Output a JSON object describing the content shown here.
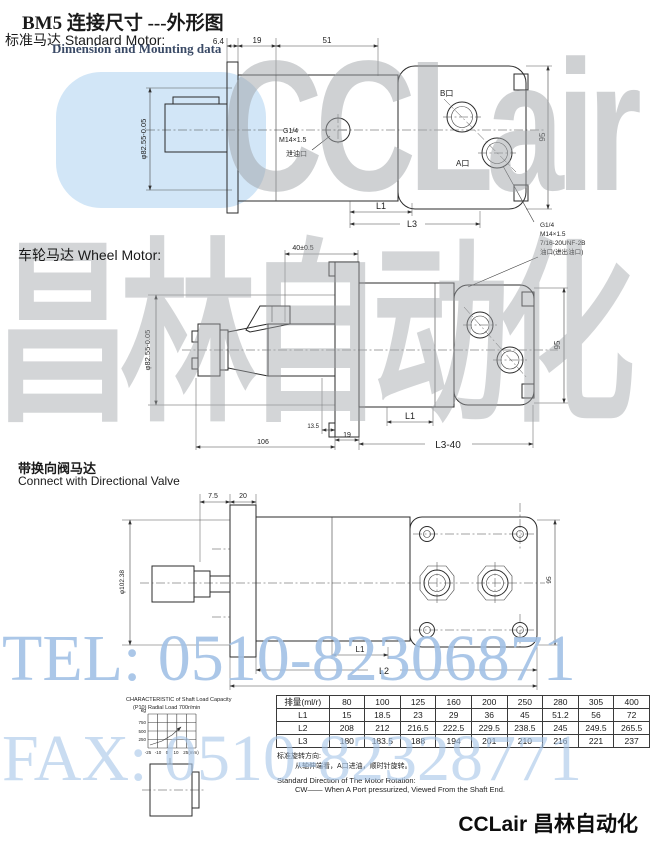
{
  "title": "BM5 连接尺寸 ---外形图",
  "subtitle": "Dimension and Mounting data",
  "watermarks": {
    "brand": "CCLair",
    "brand_cn": "昌林自动化",
    "tel": "TEL: 0510-82306871",
    "fax": "FAX: 0510-82328771",
    "blue": "#a9c7e9",
    "gray": "#a0a4a8"
  },
  "std": {
    "label_cn": "标准马达",
    "label_en": "Standard Motor:",
    "dim_6_4": "6.4",
    "dim_19": "19",
    "dim_51": "51",
    "dia": "φ82.55-0.05",
    "drain1": "G1/4",
    "drain2": "M14×1.5",
    "drain3": "泄油口",
    "port_b": "B口",
    "port_a": "A口",
    "dim_95": "95",
    "dim_l1": "L1",
    "dim_l3": "L3"
  },
  "ports_note": {
    "line1": "G1/4",
    "line2": "M14×1.5",
    "line3": "7/16-20UNF-2B",
    "line4": "油口(进出油口)"
  },
  "wheel": {
    "label_cn": "车轮马达",
    "label_en": "Wheel Motor:",
    "dim_top": "40±0.5",
    "dia": "φ82.55-0.05",
    "dim_95": "95",
    "dim_13_5": "13.5",
    "dim_19": "19",
    "dim_106": "106",
    "dim_l1": "L1",
    "dim_l3_40": "L3-40"
  },
  "valve": {
    "label_cn": "带换向阀马达",
    "label_en": "Connect with Directional Valve",
    "dim_7_5": "7.5",
    "dim_20": "20",
    "dia": "φ102.38",
    "dim_95": "95",
    "dim_l1": "L1",
    "dim_l2": "L2"
  },
  "inset": {
    "caption1": "CHARACTERISTIC of Shaft Load Capacity",
    "caption2": "(P10)  Radial Load  700r/min",
    "y_unit": "kg",
    "y_ticks": [
      "750",
      "500",
      "250"
    ],
    "x_ticks": [
      "-25",
      "-10",
      "0",
      "10",
      "25(mm)"
    ]
  },
  "table": {
    "headers": [
      "排量(ml/r)",
      "80",
      "100",
      "125",
      "160",
      "200",
      "250",
      "280",
      "305",
      "400"
    ],
    "rows": [
      [
        "L1",
        "15",
        "18.5",
        "23",
        "29",
        "36",
        "45",
        "51.2",
        "56",
        "72"
      ],
      [
        "L2",
        "208",
        "212",
        "216.5",
        "222.5",
        "229.5",
        "238.5",
        "245",
        "249.5",
        "265.5"
      ],
      [
        "L3",
        "180",
        "183.5",
        "188",
        "194",
        "201",
        "210",
        "216",
        "221",
        "237"
      ]
    ]
  },
  "notes": {
    "cn_title": "标准旋转方向:",
    "cn_body": "从轴伸端看，A口进油，顺时针旋转。",
    "en_title": "Standard Direction of The Motor Rotation:",
    "en_body": "CW—— When A Port pressurized, Viewed From the Shaft End."
  },
  "footer": {
    "brand": "CCLair 昌林自动化"
  }
}
